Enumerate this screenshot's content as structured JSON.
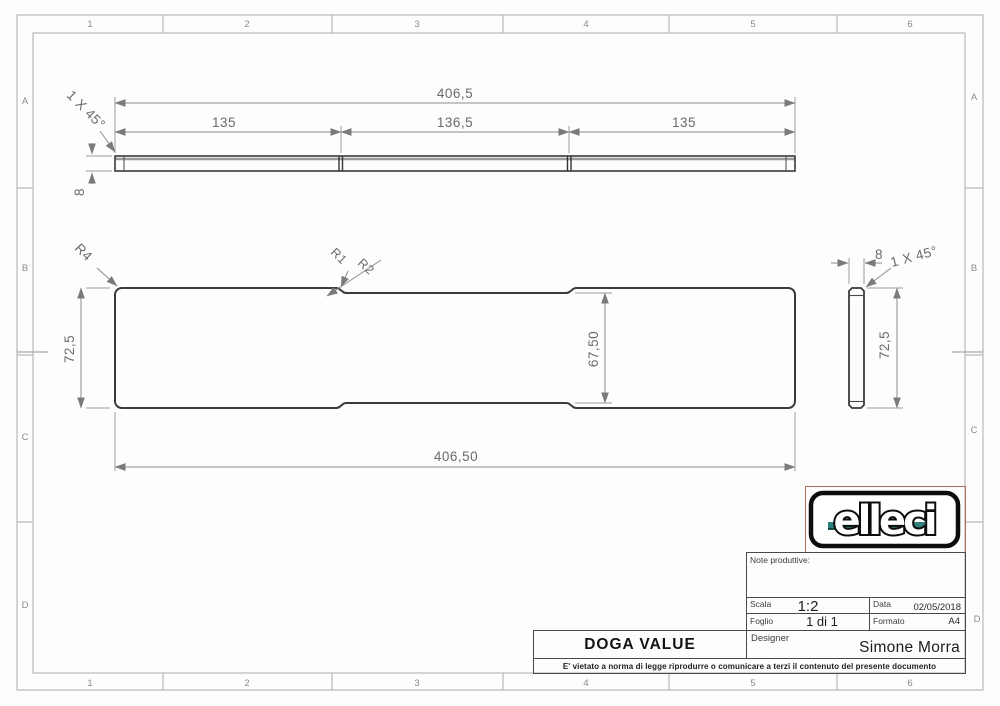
{
  "sheet": {
    "cols": [
      "1",
      "2",
      "3",
      "4",
      "5",
      "6"
    ],
    "rows": [
      "A",
      "B",
      "C",
      "D"
    ]
  },
  "views": {
    "top": {
      "total": "406,5",
      "seg_left": "135",
      "seg_mid": "136,5",
      "seg_right": "135",
      "thickness": "8",
      "chamfer": "1 X 45°"
    },
    "front": {
      "height": "72,5",
      "notch_height": "67,50",
      "total_width": "406,50",
      "fillet_r4": "R4",
      "fillet_r1": "R1",
      "fillet_r2": "R2"
    },
    "side": {
      "thickness": "8",
      "chamfer": "1 X 45°",
      "height": "72,5"
    }
  },
  "logo": {
    "text": "elleci",
    "accent_teal": "#2d7f7c",
    "frame_red": "#b26a5e"
  },
  "titleblock": {
    "notes_label": "Note produttive:",
    "scala_label": "Scala",
    "scala_value": "1:2",
    "data_label": "Data",
    "data_value": "02/05/2018",
    "foglio_label": "Foglio",
    "foglio_value": "1 di 1",
    "formato_label": "Formato",
    "formato_value": "A4",
    "designer_label": "Designer",
    "designer_value": "Simone Morra",
    "title": "DOGA VALUE",
    "disclaimer": "E' vietato a norma di legge riprodurre o comunicare a terzi il contenuto del presente documento"
  }
}
